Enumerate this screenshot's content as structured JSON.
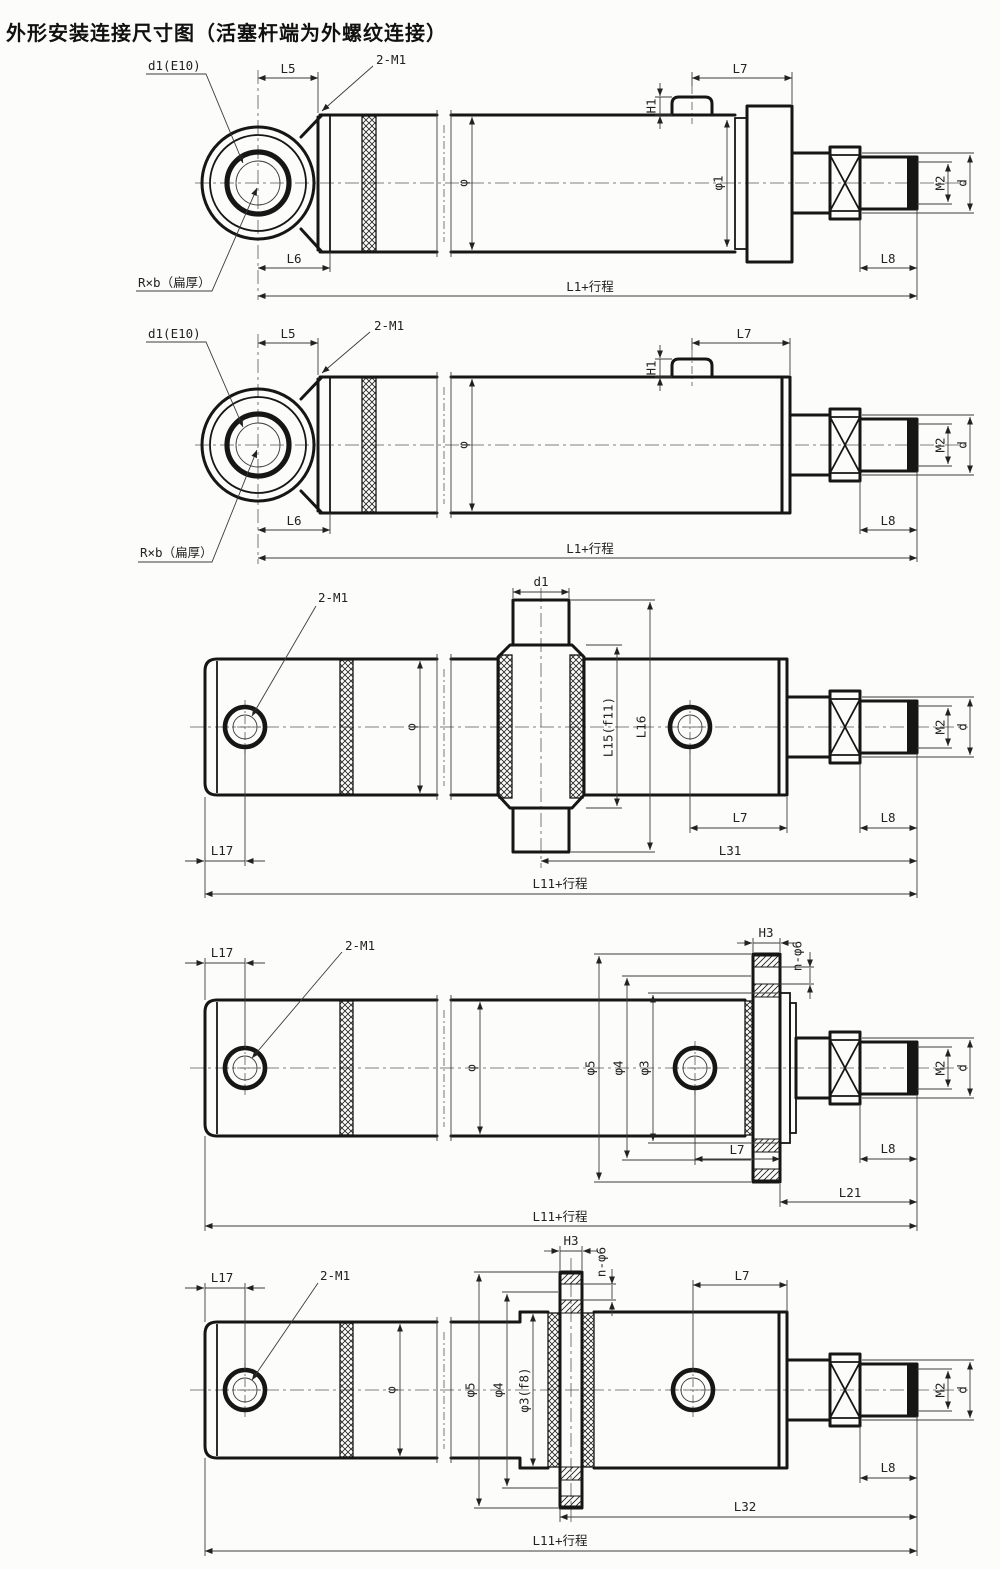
{
  "title": "外形安装连接尺寸图（活塞杆端为外螺纹连接）",
  "drawing_type": "hydraulic cylinder outline and mounting connection dimensions, 5 mounting variants, piston rod end with external thread",
  "views": [
    {
      "name": "rear eye mount with head end cap",
      "labels": {
        "d1e10": "d1(E10)",
        "l5": "L5",
        "port": "2-M1",
        "phi": "φ",
        "h1": "H1",
        "l7": "L7",
        "phi1": "φ1",
        "m2": "M2",
        "d": "d",
        "l8": "L8",
        "l6": "L6",
        "rxb": "R×b（扁厚）",
        "total": "L1+行程"
      }
    },
    {
      "name": "rear eye mount, plain head",
      "labels": {
        "d1e10": "d1(E10)",
        "l5": "L5",
        "port": "2-M1",
        "phi": "φ",
        "h1": "H1",
        "l7": "L7",
        "m2": "M2",
        "d": "d",
        "l8": "L8",
        "l6": "L6",
        "rxb": "R×b（扁厚）",
        "total": "L1+行程"
      }
    },
    {
      "name": "intermediate trunnion mount",
      "labels": {
        "port": "2-M1",
        "d1": "d1",
        "phi": "φ",
        "l15": "L15(f11)",
        "l16": "L16",
        "l17": "L17",
        "l7": "L7",
        "l8": "L8",
        "m2": "M2",
        "d": "d",
        "l31": "L31",
        "total": "L11+行程"
      }
    },
    {
      "name": "head flange mount",
      "labels": {
        "l17": "L17",
        "port": "2-M1",
        "phi": "φ",
        "phi5": "φ5",
        "phi4": "φ4",
        "phi3": "φ3",
        "h3": "H3",
        "nphi6": "n-φ6",
        "l7": "L7",
        "l8": "L8",
        "l21": "L21",
        "m2": "M2",
        "d": "d",
        "total": "L11+行程"
      }
    },
    {
      "name": "intermediate front flange mount",
      "labels": {
        "l17": "L17",
        "port": "2-M1",
        "phi": "φ",
        "phi5": "φ5",
        "phi4": "φ4",
        "phi3": "φ3(f8)",
        "h3": "H3",
        "nphi6": "n-φ6",
        "l7": "L7",
        "l8": "L8",
        "l32": "L32",
        "m2": "M2",
        "d": "d",
        "total": "L11+行程"
      }
    }
  ]
}
